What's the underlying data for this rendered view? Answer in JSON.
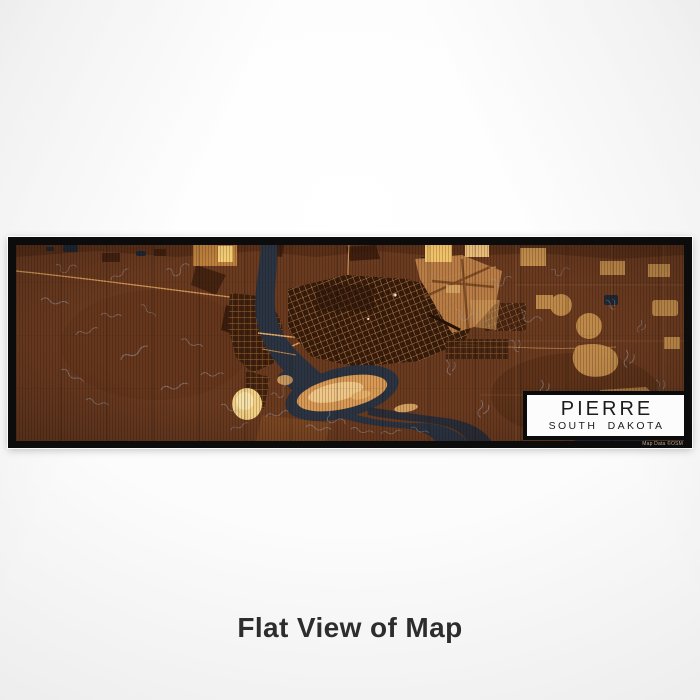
{
  "print": {
    "title": "PIERRE",
    "subtitle": "SOUTH DAKOTA",
    "attribution": "Map Data ©OSM"
  },
  "caption": "Flat View of Map",
  "map": {
    "place": "Pierre, South Dakota",
    "style_name": "ember",
    "colors": {
      "land": "#6b3b20",
      "land_dark": "#34190b",
      "water": "#2b3442",
      "field_tan": "#c6904d",
      "highlight_gold": "#f2c268",
      "island": "#d89a55",
      "island_light": "#f0c787",
      "contour": "#9fa8b8",
      "road": "#d79a55",
      "frame": "#0c0c0c",
      "card_bg": "#fcfcfc",
      "card_text": "#1c1c1c"
    }
  }
}
